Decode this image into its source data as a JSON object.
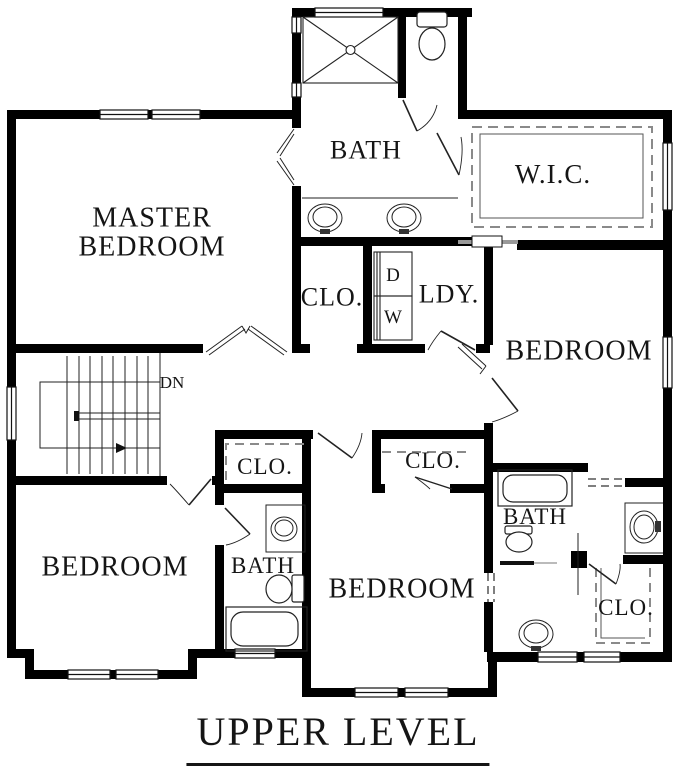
{
  "plan": {
    "title": "UPPER LEVEL",
    "labels": {
      "master_line1": "MASTER",
      "master_line2": "BEDROOM",
      "master_bath": "BATH",
      "wic": "W.I.C.",
      "hall_closet": "CLO.",
      "laundry": "LDY.",
      "dryer": "D",
      "washer": "W",
      "stairs_dn": "DN",
      "bedroom_right": "BEDROOM",
      "bedroom_left": "BEDROOM",
      "bedroom_center": "BEDROOM",
      "bath_left": "BATH",
      "bath_right": "BATH",
      "closet_left": "CLO.",
      "closet_center": "CLO.",
      "closet_right": "CLO."
    },
    "colors": {
      "wall": "#000000",
      "background": "#ffffff",
      "thin_line": "#1a1a1a",
      "dashed_shelf": "#8a8a8a"
    }
  }
}
